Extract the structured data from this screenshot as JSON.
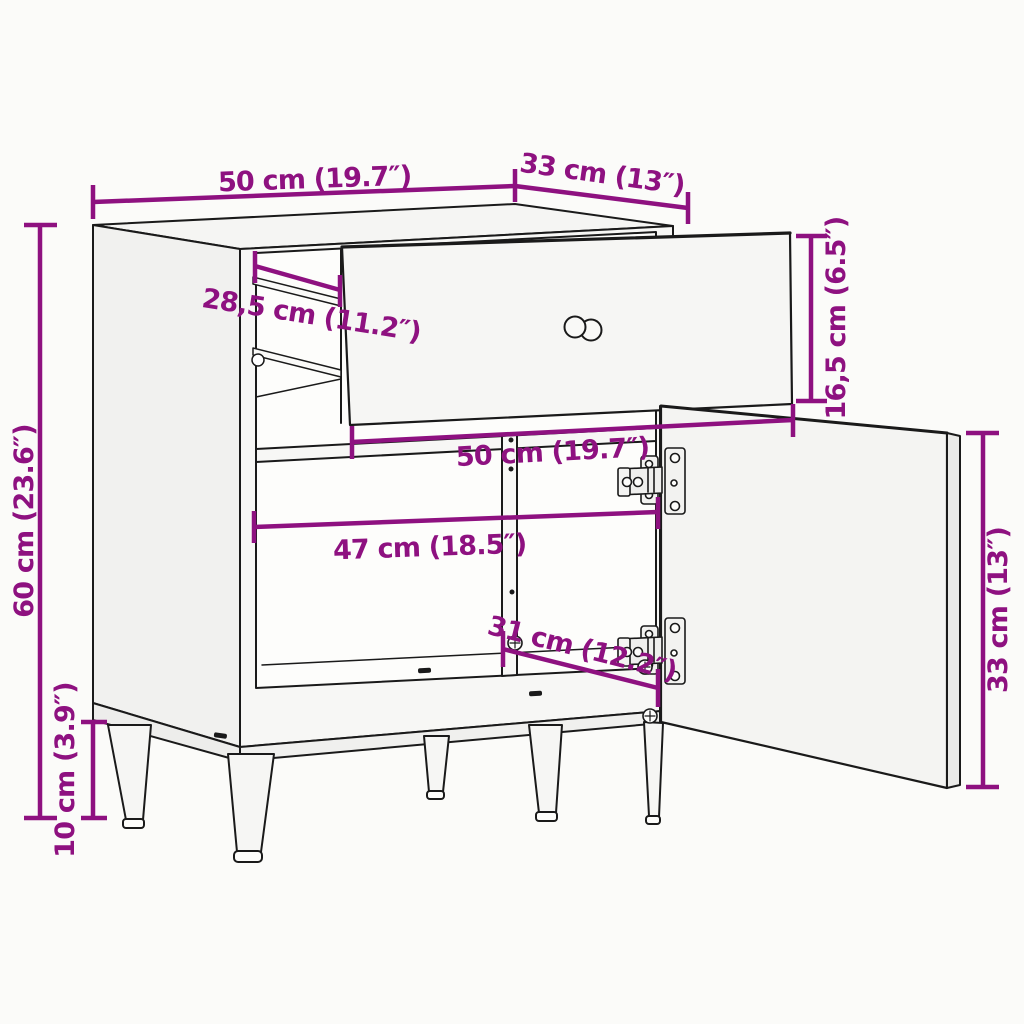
{
  "diagram": {
    "type": "furniture-dimension-diagram",
    "subject": "cabinet with pulled-out drawer and open door on legs",
    "background_color": "#fbfbf9",
    "line_color": "#1a1a1a",
    "dimension_color": "#8E1180",
    "dimensions": {
      "overall_width": "50 cm (19.7″)",
      "overall_depth": "33 cm (13″)",
      "drawer_front_height": "16,5 cm (6.5″)",
      "overall_height": "60 cm (23.6″)",
      "leg_height": "10 cm (3.9″)",
      "drawer_slide_length": "28,5 cm (11.2″)",
      "drawer_width": "50 cm (19.7″)",
      "interior_width": "47 cm (18.5″)",
      "compartment_depth": "31 cm (12.2″)",
      "door_height": "33 cm (13″)"
    }
  }
}
